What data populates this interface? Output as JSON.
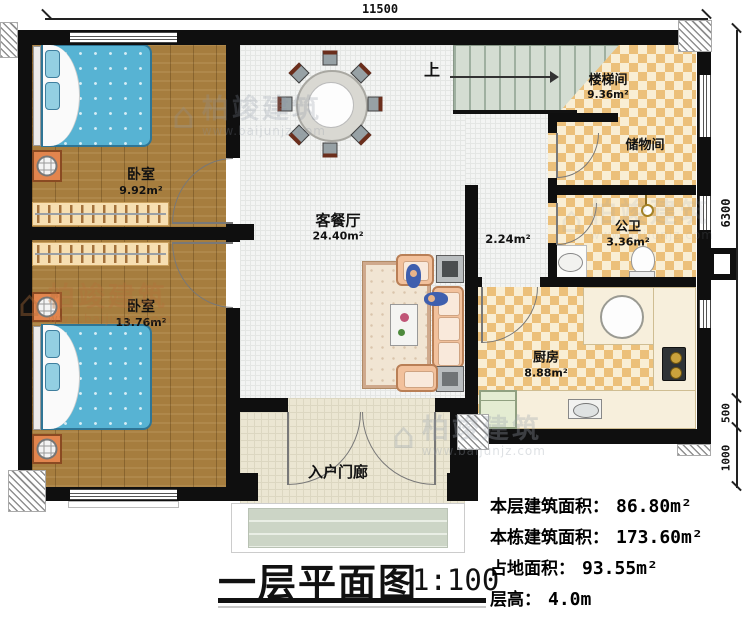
{
  "dimensions": {
    "top": "11500",
    "side_main": "6300",
    "side_porch": "500",
    "side_steps": "1000"
  },
  "rooms": {
    "bedroom1": {
      "name": "卧室",
      "area": "9.92m²"
    },
    "bedroom2": {
      "name": "卧室",
      "area": "13.76m²"
    },
    "living": {
      "name": "客餐厅",
      "area": "24.40m²"
    },
    "stairwell": {
      "name": "楼梯间",
      "area": "9.36m²"
    },
    "storage": {
      "name": "储物间"
    },
    "bathroom": {
      "name": "公卫",
      "area": "3.36m²"
    },
    "hall": {
      "area": "2.24m²"
    },
    "kitchen": {
      "name": "厨房",
      "area": "8.88m²"
    },
    "porch": {
      "name": "入户门廊"
    }
  },
  "stairs": {
    "up_label": "上"
  },
  "title": {
    "name": "一层平面图",
    "scale": "1:100"
  },
  "info": [
    {
      "label": "本层建筑面积：",
      "value": "86.80m²"
    },
    {
      "label": "本栋建筑面积：",
      "value": "173.60m²"
    },
    {
      "label": "占地面积：",
      "value": "93.55m²"
    },
    {
      "label": "层高：",
      "value": "4.0m"
    }
  ],
  "watermark": {
    "logo_glyph": "⌂",
    "brand": "柏竣建筑",
    "site": "www.baijunjz.com"
  },
  "colors": {
    "wall": "#0f0f0f",
    "wood_floor": "#a67d3e",
    "checker_floor": "#ecc07a",
    "bed": "#57b3d3",
    "stair": "#d4ddd2",
    "counter": "#f7efdc",
    "sofa": "#f2c19c"
  }
}
